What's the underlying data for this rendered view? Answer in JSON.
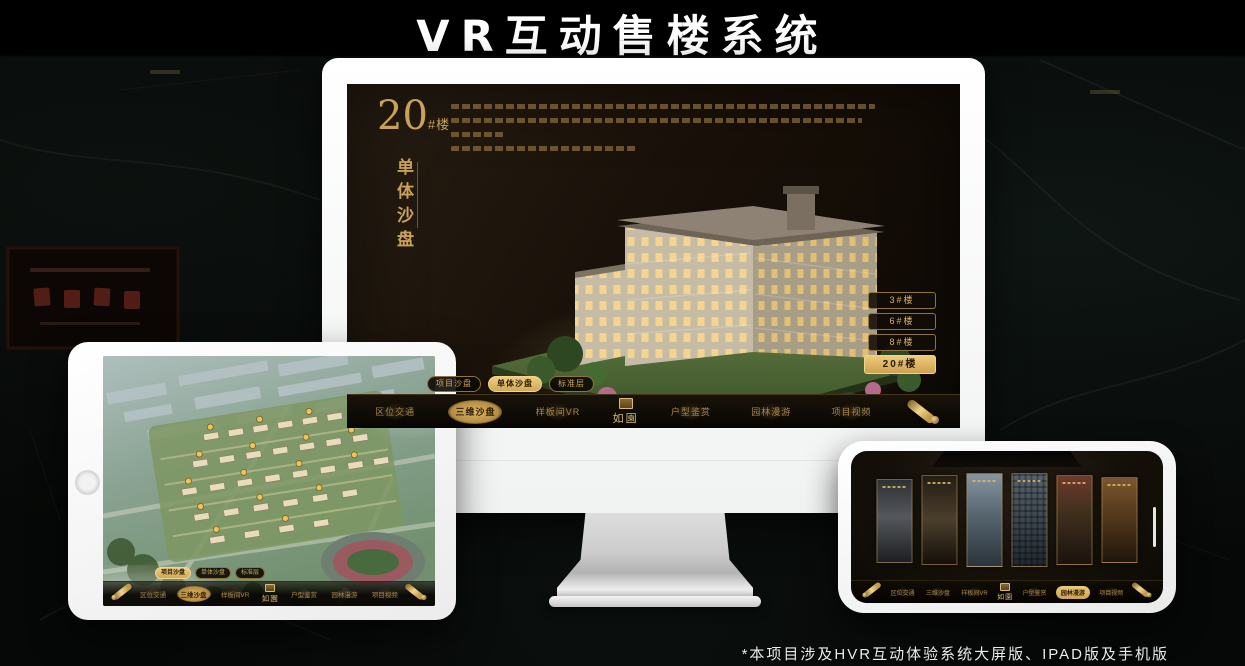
{
  "page": {
    "title": "VR互动售楼系统",
    "footnote": "*本项目涉及HVR互动体验系统大屏版、IPAD版及手机版"
  },
  "colors": {
    "accent_gold": "#cfa558",
    "gold_bright": "#e9c878",
    "screen_dark": "#17110a",
    "background": "#060807",
    "device_white": "#fafafa",
    "marker_gold": "#eac35f",
    "active_button_text": "#281b07"
  },
  "brand": {
    "logo_text": "如園",
    "logo_seal_icon": "gold-seal-square"
  },
  "icons": {
    "scroll_icon": "gold-rolled-scroll",
    "seal_icon": "gold-seal-square",
    "home_button": "gray-circle",
    "home_indicator": "white-bar"
  },
  "nav": {
    "items": [
      {
        "label": "区位交通",
        "active": false
      },
      {
        "label": "三维沙盘",
        "active": true
      },
      {
        "label": "样板间VR",
        "active": false
      },
      {
        "label": "户型鉴赏",
        "active": false
      },
      {
        "label": "园林漫游",
        "active": false
      },
      {
        "label": "项目视频",
        "active": false
      }
    ]
  },
  "subtabs": {
    "items": [
      {
        "label": "项目沙盘"
      },
      {
        "label": "单体沙盘"
      },
      {
        "label": "标准层"
      }
    ]
  },
  "monitor": {
    "title_number": "20",
    "title_suffix": "#楼",
    "title_vertical": "单体沙盘",
    "active_subtab": "单体沙盘",
    "active_nav": "三维沙盘",
    "building_buttons": [
      {
        "label": "3#楼",
        "active": false
      },
      {
        "label": "6#楼",
        "active": false
      },
      {
        "label": "8#楼",
        "active": false
      },
      {
        "label": "20#楼",
        "active": true
      }
    ]
  },
  "tablet": {
    "active_subtab": "项目沙盘",
    "active_nav": "三维沙盘"
  },
  "phone": {
    "active_nav": "园林漫游",
    "gallery_card_count": 6
  }
}
